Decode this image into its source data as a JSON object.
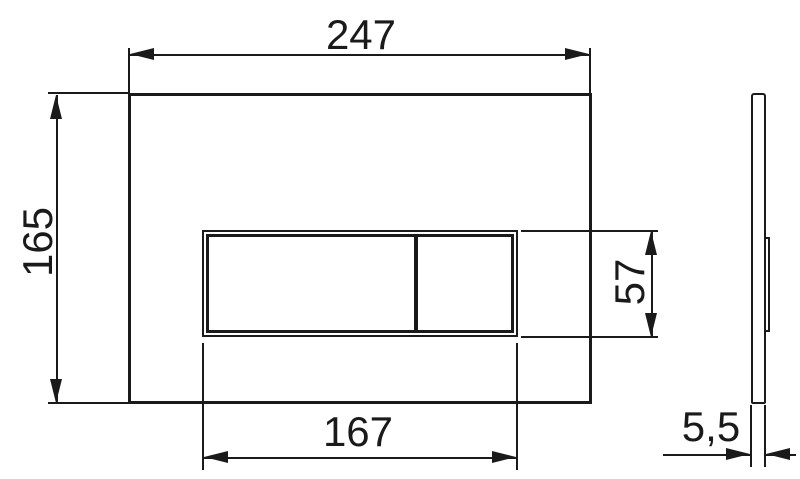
{
  "canvas": {
    "width": 800,
    "height": 479,
    "background": "#ffffff",
    "line_color": "#1a1a1a"
  },
  "drawing": {
    "kind": "technical dimension drawing, flush plate front and side views",
    "views": {
      "front": {
        "dims": {
          "plate_width": "247",
          "plate_height": "165",
          "button_width": "167",
          "button_height": "57"
        }
      },
      "side": {
        "dims": {
          "thickness": "5,5"
        }
      }
    }
  }
}
